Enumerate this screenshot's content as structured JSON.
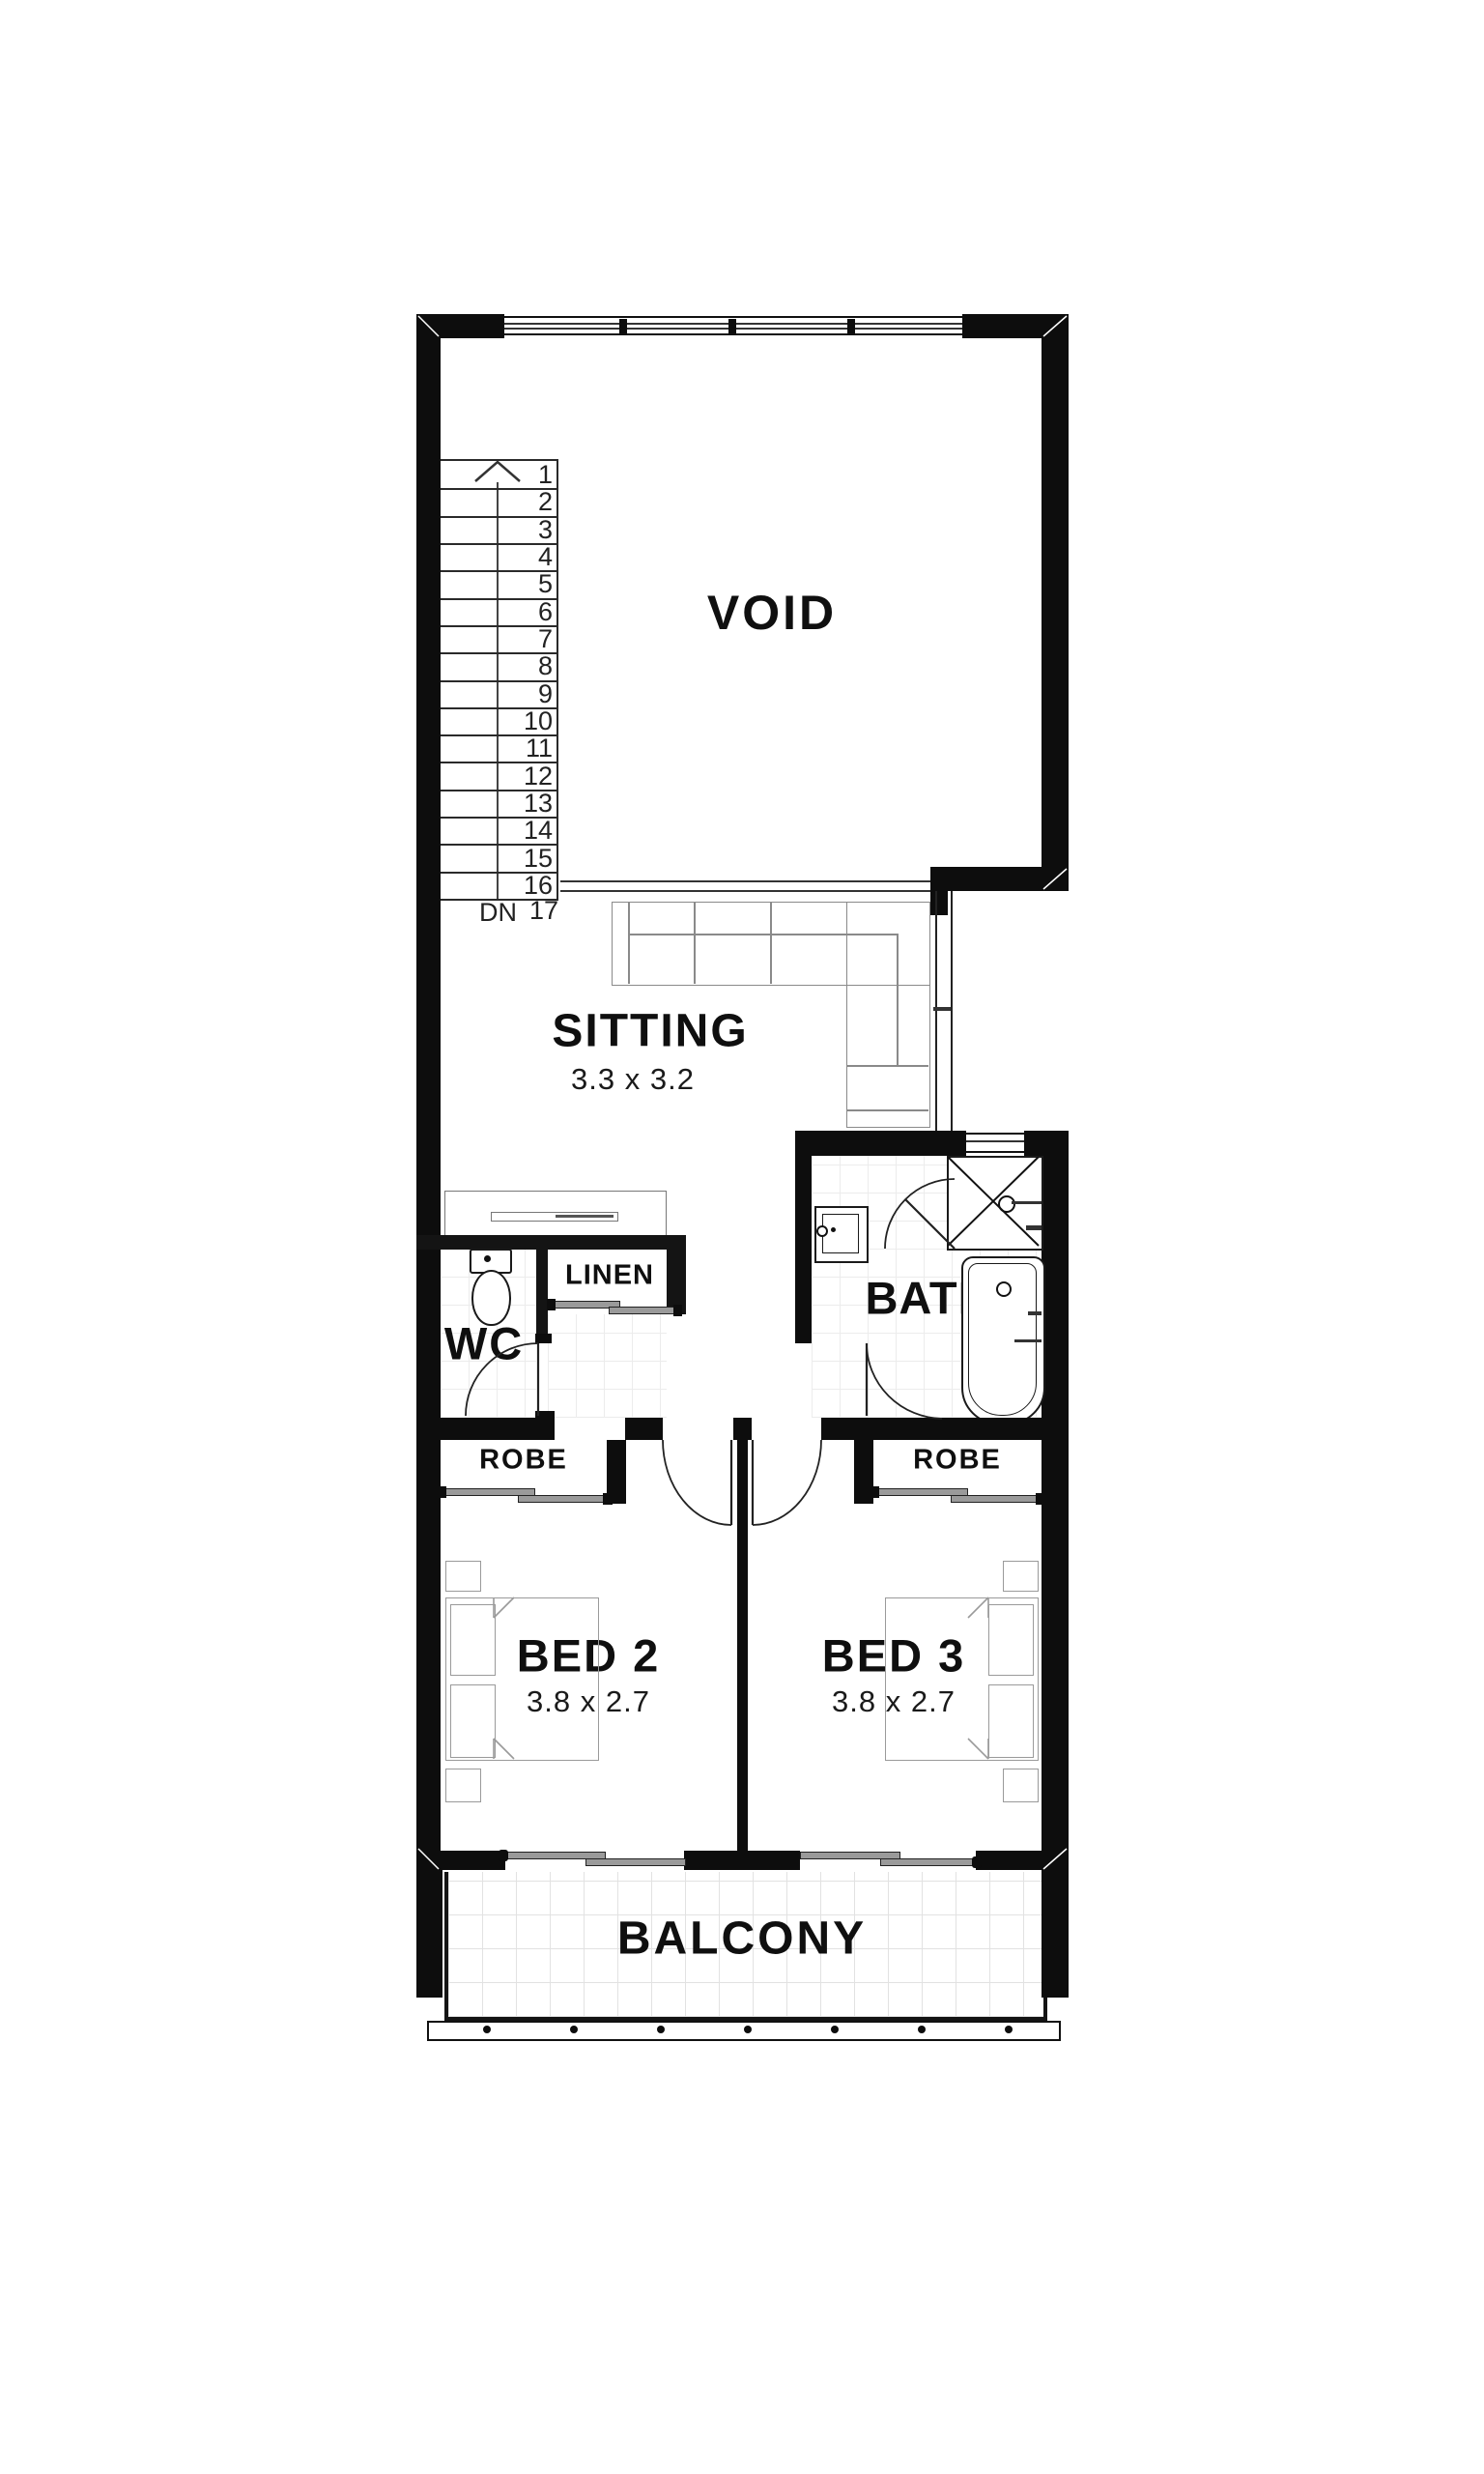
{
  "rooms": {
    "void": {
      "label": "VOID"
    },
    "sitting": {
      "label": "SITTING",
      "dims": "3.3 x 3.2"
    },
    "wc": {
      "label": "WC"
    },
    "linen": {
      "label": "LINEN"
    },
    "bath": {
      "label": "BATH"
    },
    "robe_left": {
      "label": "ROBE"
    },
    "robe_right": {
      "label": "ROBE"
    },
    "bed2": {
      "label": "BED 2",
      "dims": "3.8 x 2.7"
    },
    "bed3": {
      "label": "BED 3",
      "dims": "3.8 x 2.7"
    },
    "balcony": {
      "label": "BALCONY"
    }
  },
  "stairs": {
    "down_label": "DN",
    "step_count": 17,
    "numbers": [
      1,
      2,
      3,
      4,
      5,
      6,
      7,
      8,
      9,
      10,
      11,
      12,
      13,
      14,
      15,
      16,
      17
    ]
  },
  "colors": {
    "wall": "#0d0d0d",
    "furniture_line": "#8a8a8a",
    "text": "#111111",
    "tile": "#ececec"
  }
}
